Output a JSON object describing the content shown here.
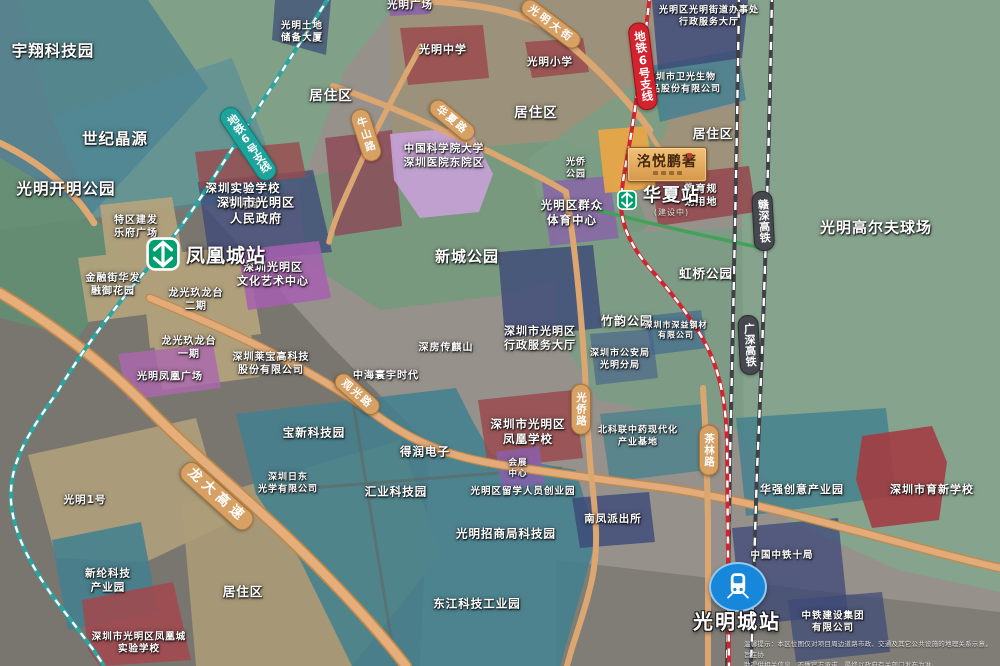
{
  "map": {
    "plaque": {
      "title": "洺悦鹏著"
    },
    "stations": {
      "fenghuangcheng": {
        "label": "凤凰城站"
      },
      "huaxia": {
        "label": "华夏站",
        "status": "(建设中)"
      },
      "guangmingcheng": {
        "label": "光明城站"
      }
    },
    "disclaimer": {
      "line1": "温馨提示：本区位图仅对项目周边道路市政、交通及其它公共设施的地理关系示意，旨在协",
      "line2": "助提供相关信息，不做官方承诺，最终以政府有关部门发布为准。"
    },
    "labels": [
      {
        "name": "yuxiang-tech-park",
        "lines": [
          "宇翔科技园"
        ],
        "x": 53,
        "y": 51,
        "size": 15.5
      },
      {
        "name": "shiji-jingyuan",
        "lines": [
          "世纪晶源"
        ],
        "x": 115,
        "y": 139,
        "size": 15.5
      },
      {
        "name": "kaiming-park",
        "lines": [
          "光明开明公园"
        ],
        "x": 66,
        "y": 189,
        "size": 15.5
      },
      {
        "name": "tudi-chubei-tower",
        "lines": [
          "光明土地",
          "储备大厦"
        ],
        "x": 302,
        "y": 33,
        "size": 9.5
      },
      {
        "name": "juzhuqu-1",
        "lines": [
          "居住区"
        ],
        "x": 331,
        "y": 97,
        "size": 13.5
      },
      {
        "name": "juzhuqu-2",
        "lines": [
          "居住区"
        ],
        "x": 536,
        "y": 114,
        "size": 13.5
      },
      {
        "name": "juzhuqu-3",
        "lines": [
          "居住区"
        ],
        "x": 713,
        "y": 134,
        "size": 12.5
      },
      {
        "name": "juzhuqu-4",
        "lines": [
          "居住区"
        ],
        "x": 243,
        "y": 592,
        "size": 12.5
      },
      {
        "name": "guangming-plaza",
        "lines": [
          "光明广场"
        ],
        "x": 410,
        "y": 6,
        "size": 10.5
      },
      {
        "name": "guangming-middle-school",
        "lines": [
          "光明中学"
        ],
        "x": 443,
        "y": 50,
        "size": 11
      },
      {
        "name": "guangming-primary-school",
        "lines": [
          "光明小学"
        ],
        "x": 550,
        "y": 63,
        "size": 10.5
      },
      {
        "name": "cas-univ-hospital",
        "lines": [
          "中国科学院大学",
          "深圳医院东院区"
        ],
        "x": 444,
        "y": 156,
        "size": 10.5
      },
      {
        "name": "shiyan-school-guangming",
        "lines": [
          "深圳实验学校",
          "光明部"
        ],
        "x": 243,
        "y": 196,
        "size": 11.5
      },
      {
        "name": "renmin-gov",
        "lines": [
          "深圳市光明区",
          "人民政府"
        ],
        "x": 256,
        "y": 211,
        "size": 12
      },
      {
        "name": "culture-art-center",
        "lines": [
          "深圳光明区",
          "文化艺术中心"
        ],
        "x": 273,
        "y": 275,
        "size": 11
      },
      {
        "name": "lefu-plaza",
        "lines": [
          "特区建发",
          "乐府广场"
        ],
        "x": 136,
        "y": 227,
        "size": 10
      },
      {
        "name": "rongyu-garden",
        "lines": [
          "金融街华发",
          "融御花园"
        ],
        "x": 113,
        "y": 285,
        "size": 10
      },
      {
        "name": "jiulongtai-2",
        "lines": [
          "龙光玖龙台",
          "二期"
        ],
        "x": 196,
        "y": 300,
        "size": 10
      },
      {
        "name": "jiulongtai-1",
        "lines": [
          "龙光玖龙台",
          "一期"
        ],
        "x": 189,
        "y": 348,
        "size": 10
      },
      {
        "name": "fenghuang-plaza",
        "lines": [
          "光明凤凰广场"
        ],
        "x": 170,
        "y": 377,
        "size": 10
      },
      {
        "name": "laibao-hightech",
        "lines": [
          "深圳莱宝高科技",
          "股份有限公司"
        ],
        "x": 271,
        "y": 364,
        "size": 10
      },
      {
        "name": "xincheng-park",
        "lines": [
          "新城公园"
        ],
        "x": 467,
        "y": 257,
        "size": 15
      },
      {
        "name": "hongqiao-park",
        "lines": [
          "虹桥公园"
        ],
        "x": 706,
        "y": 274,
        "size": 12.5
      },
      {
        "name": "golf-course",
        "lines": [
          "光明高尔夫球场"
        ],
        "x": 876,
        "y": 228,
        "size": 15
      },
      {
        "name": "jiedao-office",
        "lines": [
          "光明区光明街道办事处",
          "行政服务大厅"
        ],
        "x": 709,
        "y": 17,
        "size": 9
      },
      {
        "name": "weiguang-bio",
        "lines": [
          "深圳市卫光生物",
          "制品股份有限公司"
        ],
        "x": 681,
        "y": 84,
        "size": 9
      },
      {
        "name": "guangqiao-park",
        "lines": [
          "光侨",
          "公园"
        ],
        "x": 576,
        "y": 169,
        "size": 9
      },
      {
        "name": "qunzhong-sports-center",
        "lines": [
          "光明区群众",
          "体育中心"
        ],
        "x": 572,
        "y": 213,
        "size": 11.5
      },
      {
        "name": "education-planning-land",
        "lines": [
          "教育规",
          "划用地"
        ],
        "x": 701,
        "y": 196,
        "size": 10
      },
      {
        "name": "admin-service-hall",
        "lines": [
          "深圳市光明区",
          "行政服务大厅"
        ],
        "x": 540,
        "y": 339,
        "size": 11
      },
      {
        "name": "zhuyun-park",
        "lines": [
          "竹韵公园"
        ],
        "x": 627,
        "y": 322,
        "size": 12
      },
      {
        "name": "public-security-bureau",
        "lines": [
          "深圳市公安局",
          "光明分局"
        ],
        "x": 620,
        "y": 360,
        "size": 9
      },
      {
        "name": "shenyi-steel",
        "lines": [
          "深圳市深益钢材",
          "有限公司"
        ],
        "x": 676,
        "y": 331,
        "size": 8
      },
      {
        "name": "chuanqishan",
        "lines": [
          "深房传麒山"
        ],
        "x": 446,
        "y": 348,
        "size": 10
      },
      {
        "name": "zhonghai-huanyu",
        "lines": [
          "中海寰宇时代"
        ],
        "x": 386,
        "y": 376,
        "size": 10
      },
      {
        "name": "baoxin-tech-park",
        "lines": [
          "宝新科技园"
        ],
        "x": 314,
        "y": 433,
        "size": 11.5
      },
      {
        "name": "nitto-optics",
        "lines": [
          "深圳日东",
          "光学有限公司"
        ],
        "x": 288,
        "y": 484,
        "size": 9
      },
      {
        "name": "derun-electronics",
        "lines": [
          "得润电子"
        ],
        "x": 425,
        "y": 452,
        "size": 11.5
      },
      {
        "name": "huiye-tech-park",
        "lines": [
          "汇业科技园"
        ],
        "x": 396,
        "y": 492,
        "size": 11.5
      },
      {
        "name": "fenghuang-school",
        "lines": [
          "深圳市光明区",
          "凤凰学校"
        ],
        "x": 528,
        "y": 432,
        "size": 11.5
      },
      {
        "name": "convention-center",
        "lines": [
          "会展",
          "中心"
        ],
        "x": 518,
        "y": 469,
        "size": 8.5
      },
      {
        "name": "liuxue-startup-park",
        "lines": [
          "光明区留学人员创业园"
        ],
        "x": 523,
        "y": 492,
        "size": 9.5
      },
      {
        "name": "zhaoshang-tech-park",
        "lines": [
          "光明招商局科技园"
        ],
        "x": 506,
        "y": 534,
        "size": 11.5
      },
      {
        "name": "dongjiang-industry-park",
        "lines": [
          "东江科技工业园"
        ],
        "x": 477,
        "y": 604,
        "size": 11.5
      },
      {
        "name": "beikelian-pharma-base",
        "lines": [
          "北科联中药现代化",
          "产业基地"
        ],
        "x": 638,
        "y": 437,
        "size": 9
      },
      {
        "name": "nanfeng-police",
        "lines": [
          "南凤派出所"
        ],
        "x": 613,
        "y": 520,
        "size": 10.5
      },
      {
        "name": "guangming-no1",
        "lines": [
          "光明1号"
        ],
        "x": 85,
        "y": 501,
        "size": 10.5
      },
      {
        "name": "xinlun-tech-park",
        "lines": [
          "新纶科技",
          "产业园"
        ],
        "x": 108,
        "y": 581,
        "size": 10.5
      },
      {
        "name": "fenghuangcheng-exp-school",
        "lines": [
          "深圳市光明区凤凰城",
          "实验学校"
        ],
        "x": 139,
        "y": 644,
        "size": 9.5
      },
      {
        "name": "huaqiang-creative-park",
        "lines": [
          "华强创意产业园"
        ],
        "x": 802,
        "y": 490,
        "size": 11
      },
      {
        "name": "yuxin-school",
        "lines": [
          "深圳市育新学校"
        ],
        "x": 932,
        "y": 490,
        "size": 11
      },
      {
        "name": "crec-10th-bureau",
        "lines": [
          "中国中铁十局"
        ],
        "x": 782,
        "y": 556,
        "size": 9.5
      },
      {
        "name": "crcc-group",
        "lines": [
          "中铁建设集团",
          "有限公司"
        ],
        "x": 833,
        "y": 623,
        "size": 9.5
      },
      {
        "name": "road-guangming-street",
        "lines": [
          "光明大街"
        ],
        "x": 551,
        "y": 24,
        "size": 10.5,
        "type": "road",
        "rotate": 37,
        "spacing": 3
      },
      {
        "name": "road-niushan",
        "lines": [
          "牛山路"
        ],
        "x": 366,
        "y": 135,
        "size": 10.5,
        "type": "road",
        "rotate": -18,
        "vertical": true,
        "spacing": 2
      },
      {
        "name": "road-huaxia",
        "lines": [
          "华夏路"
        ],
        "x": 452,
        "y": 120,
        "size": 10.5,
        "type": "road",
        "rotate": 40,
        "spacing": 2
      },
      {
        "name": "road-guanguang",
        "lines": [
          "观光路"
        ],
        "x": 357,
        "y": 394,
        "size": 10.5,
        "type": "road",
        "rotate": 41,
        "spacing": 2
      },
      {
        "name": "road-guangqiao",
        "lines": [
          "光侨路"
        ],
        "x": 581,
        "y": 409,
        "size": 10.5,
        "type": "road",
        "vertical": true,
        "spacing": 1
      },
      {
        "name": "road-chalin",
        "lines": [
          "茶林路"
        ],
        "x": 709,
        "y": 450,
        "size": 10.5,
        "type": "road",
        "vertical": true,
        "spacing": 1
      },
      {
        "name": "road-longda-expressway",
        "lines": [
          "龙大高速"
        ],
        "x": 217,
        "y": 496,
        "size": 13.5,
        "type": "road",
        "rotate": 42,
        "spacing": 5
      },
      {
        "name": "metro-line6-branch-west",
        "lines": [
          "地铁6号支线"
        ],
        "x": 248,
        "y": 144,
        "size": 11,
        "type": "metro-teal",
        "vertical": true,
        "rotate": -34
      },
      {
        "name": "metro-line6-branch-east",
        "lines": [
          "地铁6号支线"
        ],
        "x": 643,
        "y": 66,
        "size": 11.5,
        "type": "metro-red",
        "vertical": true,
        "rotate": -7
      },
      {
        "name": "ganshen-hsr",
        "lines": [
          "赣深高铁"
        ],
        "x": 763,
        "y": 221,
        "size": 11,
        "type": "rail",
        "vertical": true,
        "rotate": -3
      },
      {
        "name": "guangshen-hsr",
        "lines": [
          "广深高铁"
        ],
        "x": 749,
        "y": 345,
        "size": 11,
        "type": "rail",
        "vertical": true,
        "rotate": -3
      }
    ]
  },
  "colors": {
    "metro_line_teal": "#2aa5a0",
    "metro_line_red": "#cf2530",
    "railway_dark": "#3e4146",
    "road_tan": "#e3ab79",
    "station_logo_green": "#00a06e",
    "station_train_blue": "#1687da",
    "plaque_gold": "#e2a75c",
    "park_green": "#7b9d84",
    "industry_teal": "#41808f",
    "gov_navy": "#3c4878",
    "school_red": "#9a4a4e"
  }
}
